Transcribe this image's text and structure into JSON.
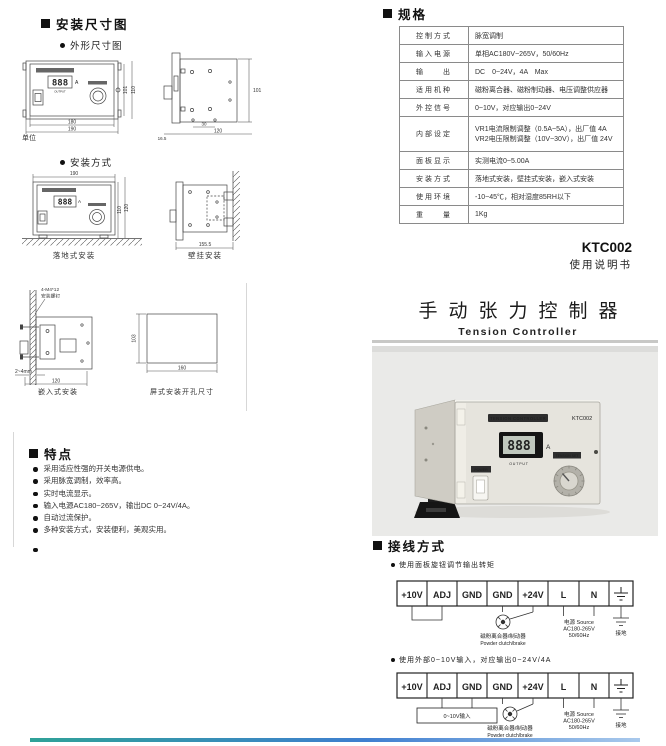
{
  "install": {
    "section_title": "安装尺寸图",
    "outline_title": "外形尺寸图",
    "method_title": "安装方式",
    "unit_label": "单位",
    "panel": {
      "display": "888",
      "amp": "A",
      "output": "OUTPUT"
    },
    "outline_front": {
      "dim_w_inner": "180",
      "dim_w_outer": "190",
      "dim_h_inner": "101",
      "dim_h_outer": "110"
    },
    "outline_side": {
      "dim_h": "101",
      "dim_hole": "30",
      "dim_w": "120",
      "dim_flange": "16.5"
    },
    "floor": {
      "label": "落地式安装",
      "dim_w": "190",
      "dim_h_inner": "110",
      "dim_h_outer": "120"
    },
    "wall": {
      "label": "壁挂安装",
      "dim_depth": "155.5"
    },
    "embed": {
      "label": "嵌入式安装",
      "screw1": "4-M4*12",
      "screw2": "安装螺钉",
      "gap": "2~4mm",
      "dim_w": "120"
    },
    "cutout": {
      "label": "屏式安装开孔尺寸",
      "dim_h": "103",
      "dim_w": "160"
    }
  },
  "features": {
    "title": "特点",
    "items": [
      "采用适应性强的开关电源供电。",
      "采用脉宽调制，效率高。",
      "实时电流显示。",
      "输入电源AC180~265V，输出DC 0~24V/4A。",
      "自动过流保护。",
      "多种安装方式，安装便利，美观实用。",
      ""
    ]
  },
  "specs": {
    "title": "规格",
    "rows": [
      {
        "label": "控制方式",
        "value": "脉宽调制"
      },
      {
        "label": "输入电源",
        "value": "单相AC180V~265V，50/60Hz"
      },
      {
        "label": "输　　出",
        "value": "DC　0~24V，4A　Max"
      },
      {
        "label": "适用机种",
        "value": "磁粉离合器、磁粉制动器、电压调整供应器"
      },
      {
        "label": "外控信号",
        "value": "0~10V，对应输出0~24V"
      },
      {
        "label": "内部设定",
        "value": "VR1电流限制调整（0.5A~5A），出厂值 4A",
        "value2": "VR2电压限制调整（10V~30V），出厂值 24V"
      },
      {
        "label": "面板显示",
        "value": "实测电流0~5.00A"
      },
      {
        "label": "安装方式",
        "value": "落地式安装，壁挂式安装，嵌入式安装"
      },
      {
        "label": "使用环境",
        "value": "-10~45℃，相对湿度85RH以下"
      },
      {
        "label": "重　　量",
        "value": "1Kg"
      }
    ]
  },
  "header": {
    "model": "KTC002",
    "manual": "使用说明书",
    "title_cn": "手动张力控制器",
    "title_en": "Tension Controller"
  },
  "photo": {
    "brand": "TENSION CONTROLLER",
    "model": "KTC002",
    "display": "888",
    "amp": "A",
    "output": "OUTPUT",
    "power": "POWER",
    "tension_set": "TENSION SET"
  },
  "wiring": {
    "title": "接线方式",
    "note1": "使用面板旋钮调节输出转矩",
    "note2": "使用外部0~10V输入，对应输出0~24V/4A",
    "terminals": [
      "+10V",
      "ADJ",
      "GND",
      "GND",
      "+24V",
      "L",
      "N"
    ],
    "clutch_cn": "磁粉离合器/制动器",
    "clutch_en": "Powder clutch/brake",
    "source1": "电源 Source",
    "source2": "AC180-265V",
    "source3": "50/60Hz",
    "ground": "接地",
    "ext_input": "0~10V输入"
  }
}
